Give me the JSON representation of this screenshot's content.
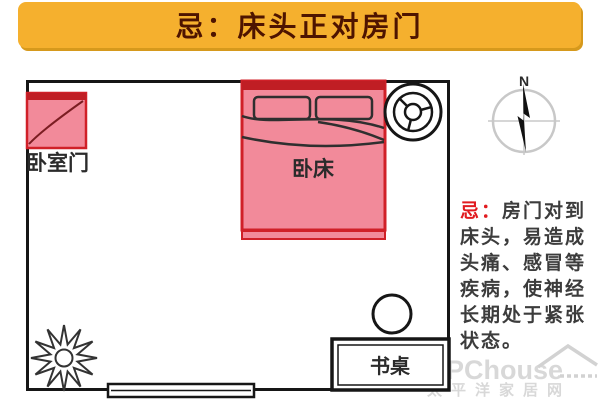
{
  "banner": {
    "title": "忌：床头正对房门"
  },
  "room": {
    "door_label": "卧室门",
    "bed_label": "卧床",
    "desk_label": "书桌",
    "compass_label": "N"
  },
  "annotation": {
    "prefix": "忌：",
    "first_line": "房门对到",
    "lines": [
      "床头，易造成",
      "头痛、感冒等",
      "疾病，使神经",
      "长期处于紧张",
      "状态。"
    ]
  },
  "watermark": {
    "brand": "PChouse",
    "site": "太平洋家居网"
  },
  "colors": {
    "banner_bg": "#F5B02E",
    "banner_shadow": "#D6991C",
    "banner_text": "#4E1400",
    "pink": "#F28A9A",
    "red": "#D02028",
    "dark_red": "#C01E24",
    "taboo_red": "#E11B20",
    "ann_text": "#3C3C3C",
    "ink": "#2F2F2F",
    "wall": "#161616",
    "wm": "#D2D2D2"
  }
}
